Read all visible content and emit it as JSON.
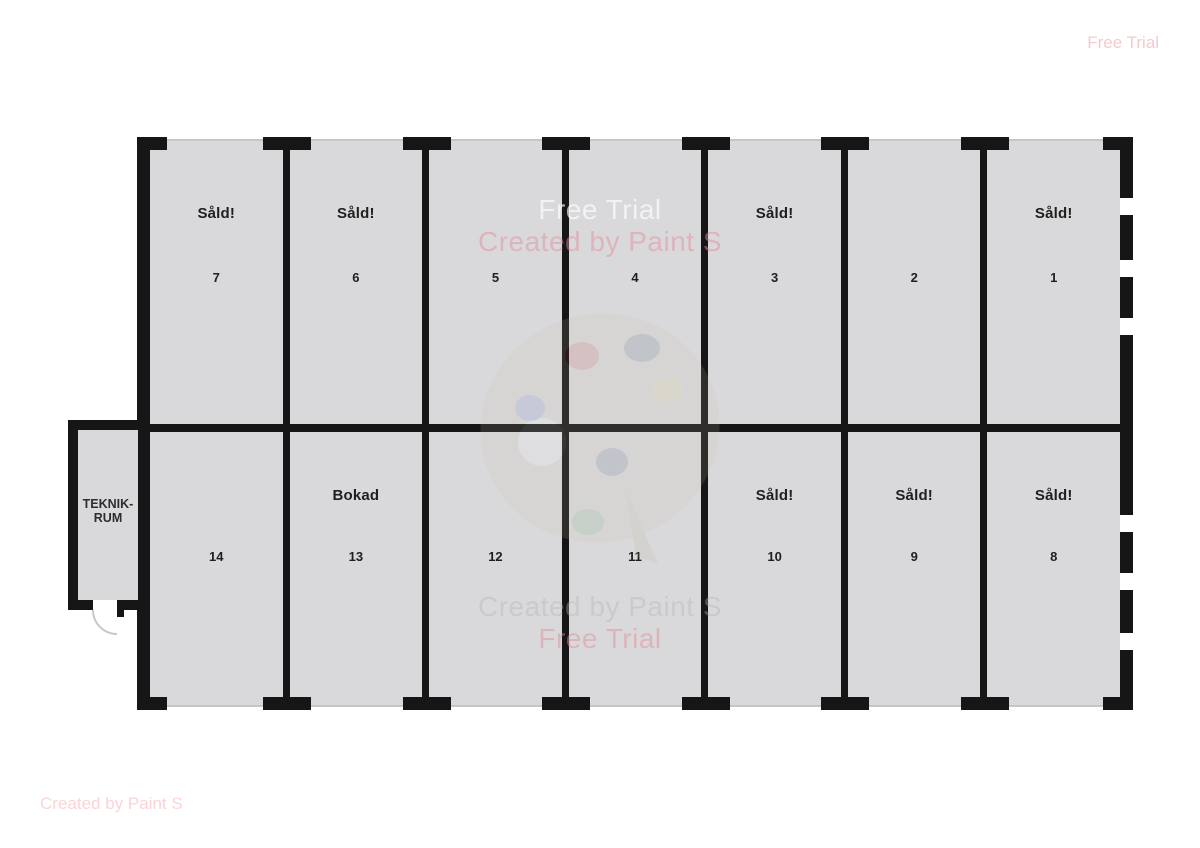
{
  "watermarks": {
    "top_right": "Free Trial",
    "bottom_left": "Created by Paint S",
    "center_top": {
      "line1": "Free Trial",
      "line2": "Created by Paint S"
    },
    "center_bottom": {
      "line1": "Created by Paint S",
      "line2": "Free Trial"
    }
  },
  "building": {
    "annex": {
      "label_line1": "TEKNIK-",
      "label_line2": "RUM"
    },
    "units": {
      "top_row": [
        {
          "number": "7",
          "status": "Såld!"
        },
        {
          "number": "6",
          "status": "Såld!"
        },
        {
          "number": "5",
          "status": ""
        },
        {
          "number": "4",
          "status": ""
        },
        {
          "number": "3",
          "status": "Såld!"
        },
        {
          "number": "2",
          "status": ""
        },
        {
          "number": "1",
          "status": "Såld!"
        }
      ],
      "bottom_row": [
        {
          "number": "14",
          "status": ""
        },
        {
          "number": "13",
          "status": "Bokad"
        },
        {
          "number": "12",
          "status": ""
        },
        {
          "number": "11",
          "status": ""
        },
        {
          "number": "10",
          "status": "Såld!"
        },
        {
          "number": "9",
          "status": "Såld!"
        },
        {
          "number": "8",
          "status": "Såld!"
        }
      ]
    }
  },
  "colors": {
    "wall": "#161616",
    "room_fill": "#d9d9db",
    "open_edge_line": "#c6c6c6",
    "watermark_pink": "#f7c9ce",
    "status_text": "#1f1f1f"
  }
}
